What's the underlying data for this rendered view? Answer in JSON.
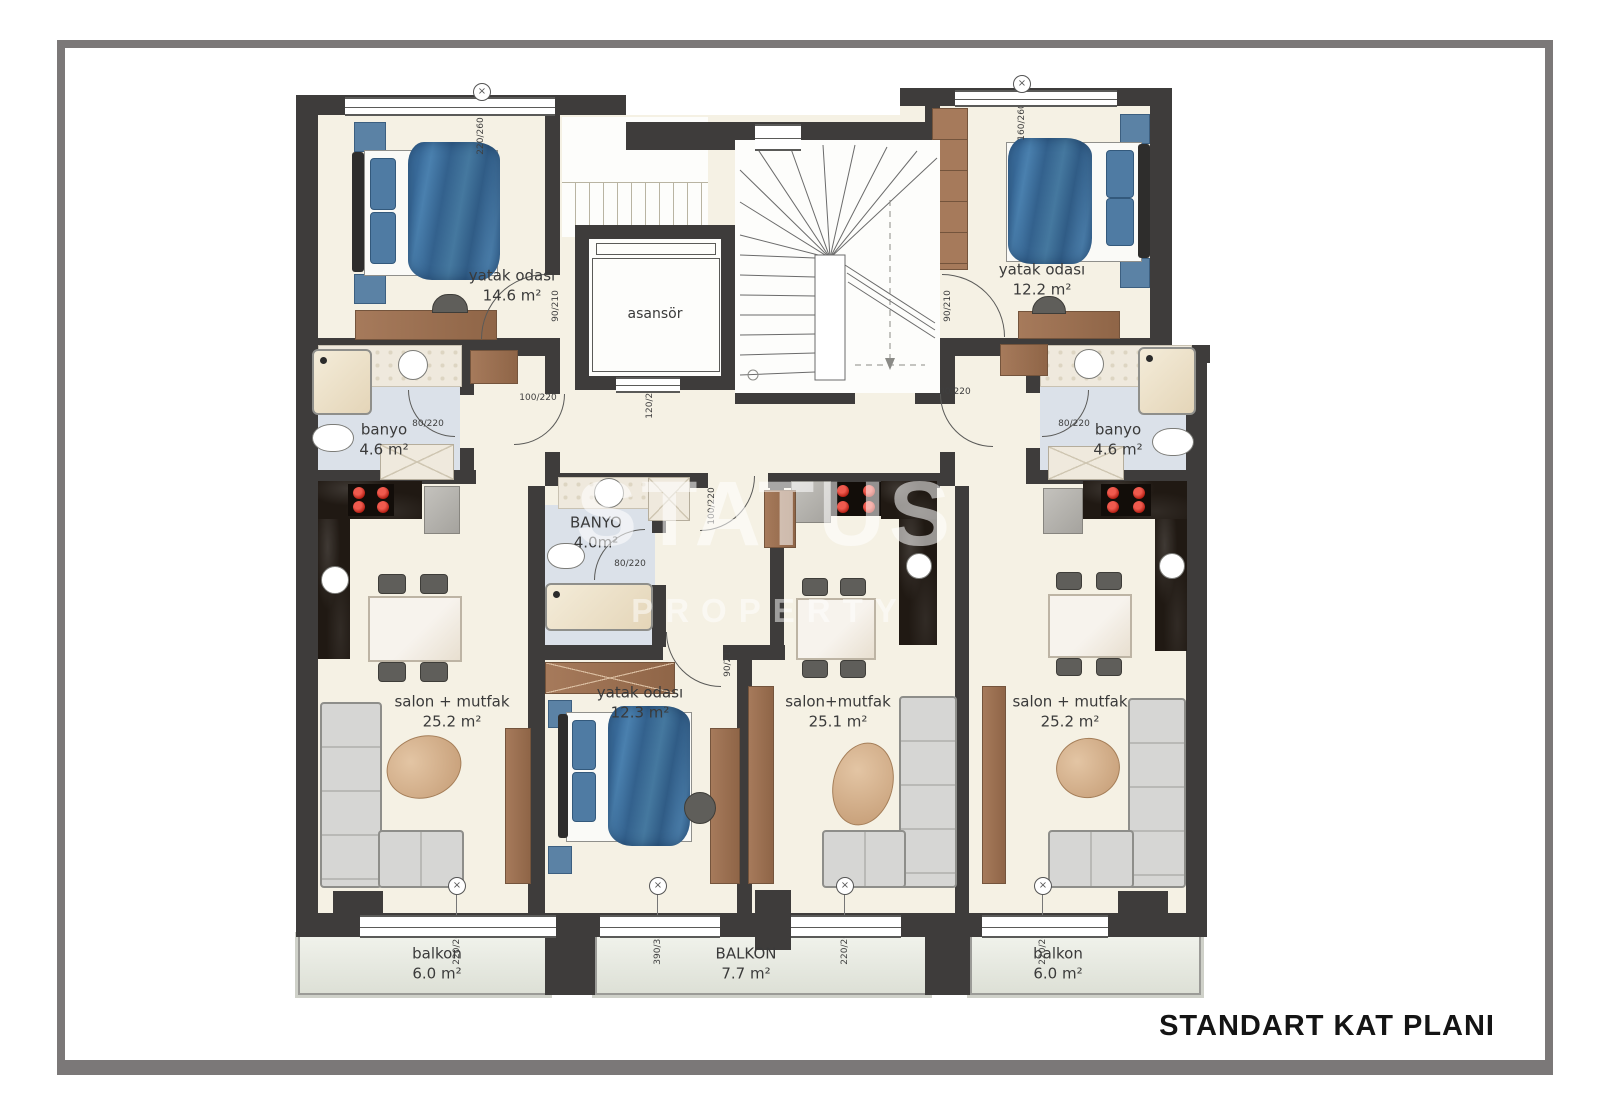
{
  "title": "STANDART KAT PLANI",
  "watermark": {
    "line1": "STATUS",
    "line2": "PROPERTY"
  },
  "rooms": {
    "bedroom_top_left": {
      "name": "yatak odası",
      "area": "14.6 m²"
    },
    "bedroom_top_right": {
      "name": "yatak odası",
      "area": "12.2 m²"
    },
    "bedroom_middle": {
      "name": "yatak odası",
      "area": "12.3 m²"
    },
    "bathroom_left": {
      "name": "banyo",
      "area": "4.6 m²"
    },
    "bathroom_middle": {
      "name": "BANYO",
      "area": "4.0m²"
    },
    "bathroom_right": {
      "name": "banyo",
      "area": "4.6 m²"
    },
    "living_left": {
      "name": "salon + mutfak",
      "area": "25.2 m²"
    },
    "living_middle": {
      "name": "salon+mutfak",
      "area": "25.1 m²"
    },
    "living_right": {
      "name": "salon + mutfak",
      "area": "25.2 m²"
    },
    "elevator": {
      "name": "asansör"
    },
    "balcony_left": {
      "name": "balkon",
      "area": "6.0 m²"
    },
    "balcony_middle": {
      "name": "BALKON",
      "area": "7.7 m²"
    },
    "balcony_right": {
      "name": "balkon",
      "area": "6.0 m²"
    }
  },
  "dims": {
    "window_top_left": "220/260",
    "window_top_right": "160/260",
    "window_bottom_left": "220/260",
    "window_bottom_bedroom": "390/330",
    "window_bottom_middle": "220/260",
    "window_bottom_right": "220/260",
    "door_bedroom_left": "90/210",
    "door_bedroom_right": "90/210",
    "door_bedroom_middle": "90/210",
    "door_bath_left": "80/220",
    "door_bath_middle": "80/220",
    "door_bath_right": "80/220",
    "door_entry_left": "100/220",
    "door_entry_right": "100/220",
    "door_entry_middle": "100/220",
    "elevator_size": "120/200"
  },
  "symbols": {
    "window_marker": "×"
  },
  "colors": {
    "wall": "#3e3c3b",
    "floor_cream": "#f5f1e4",
    "bathroom_floor": "#dbe1e9",
    "balcony_floor": "#e9ebe2",
    "wood": "#9d7355",
    "bed_blanket": "#41729e",
    "stove_burner": "#c9251f",
    "counter_dark": "#201913",
    "sofa": "#d6d6d4",
    "frame_border": "#7b7878",
    "watermark": "#ffffff"
  }
}
